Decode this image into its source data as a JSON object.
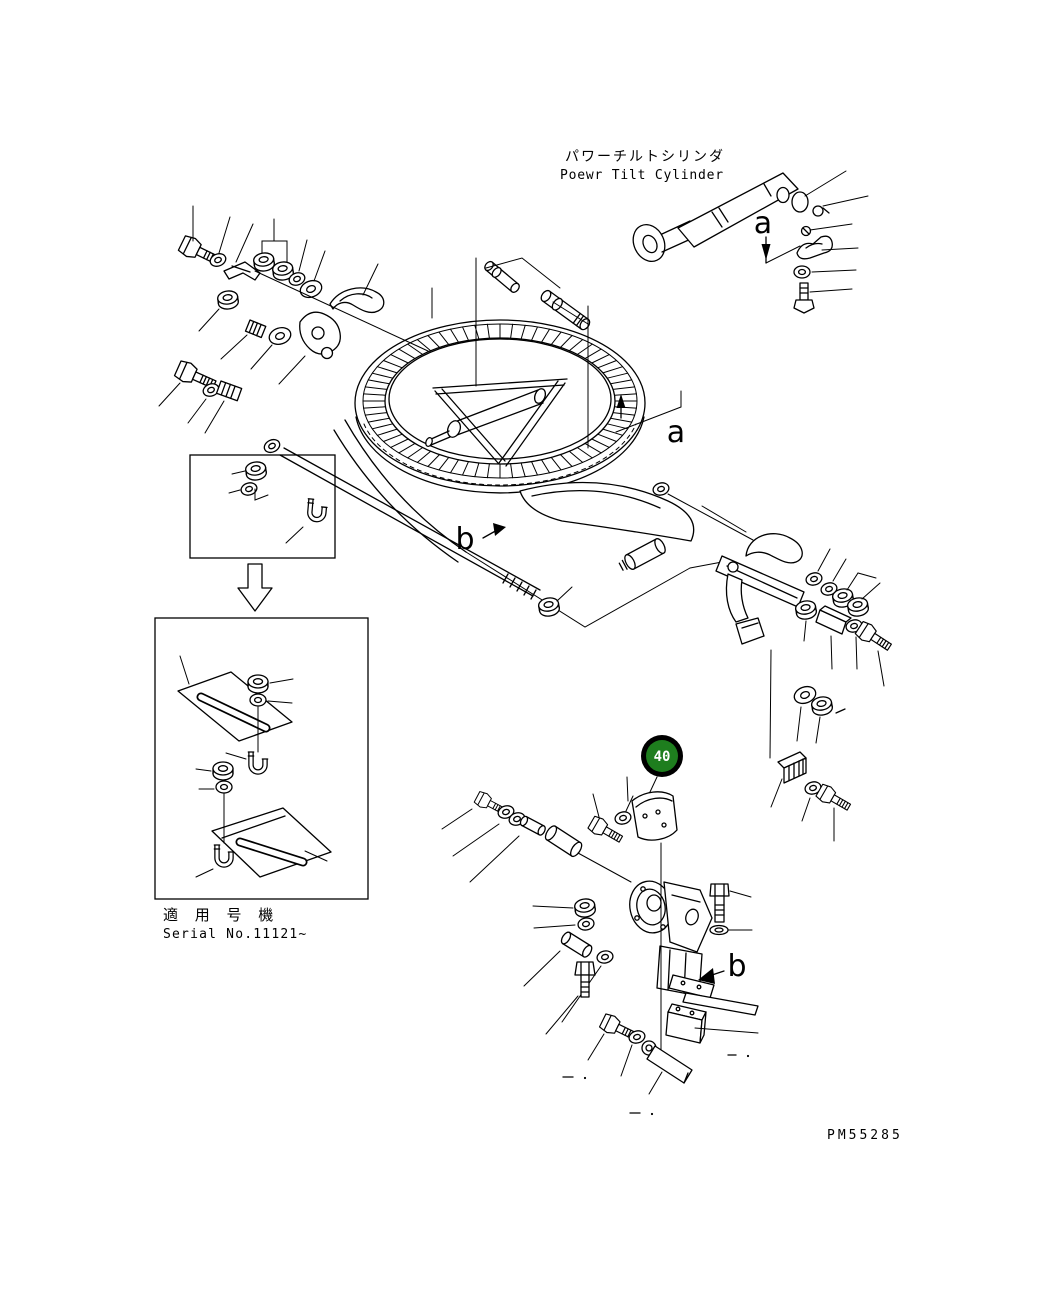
{
  "diagram": {
    "title_jp": "パワーチルトシリンダ",
    "title_en": "Poewr Tilt Cylinder",
    "labels": {
      "a1": "a",
      "a2": "a",
      "b1": "b",
      "b2": "b"
    },
    "callout": {
      "number": "40",
      "fill_color": "#1e7e1e",
      "ring_color": "#000000",
      "text_color": "#ffffff"
    },
    "serial_note_jp": "適 用 号 機",
    "serial_note_en": "Serial No.11121~",
    "doc_number": "PM55285",
    "colors": {
      "line": "#000000",
      "background": "#ffffff"
    }
  }
}
